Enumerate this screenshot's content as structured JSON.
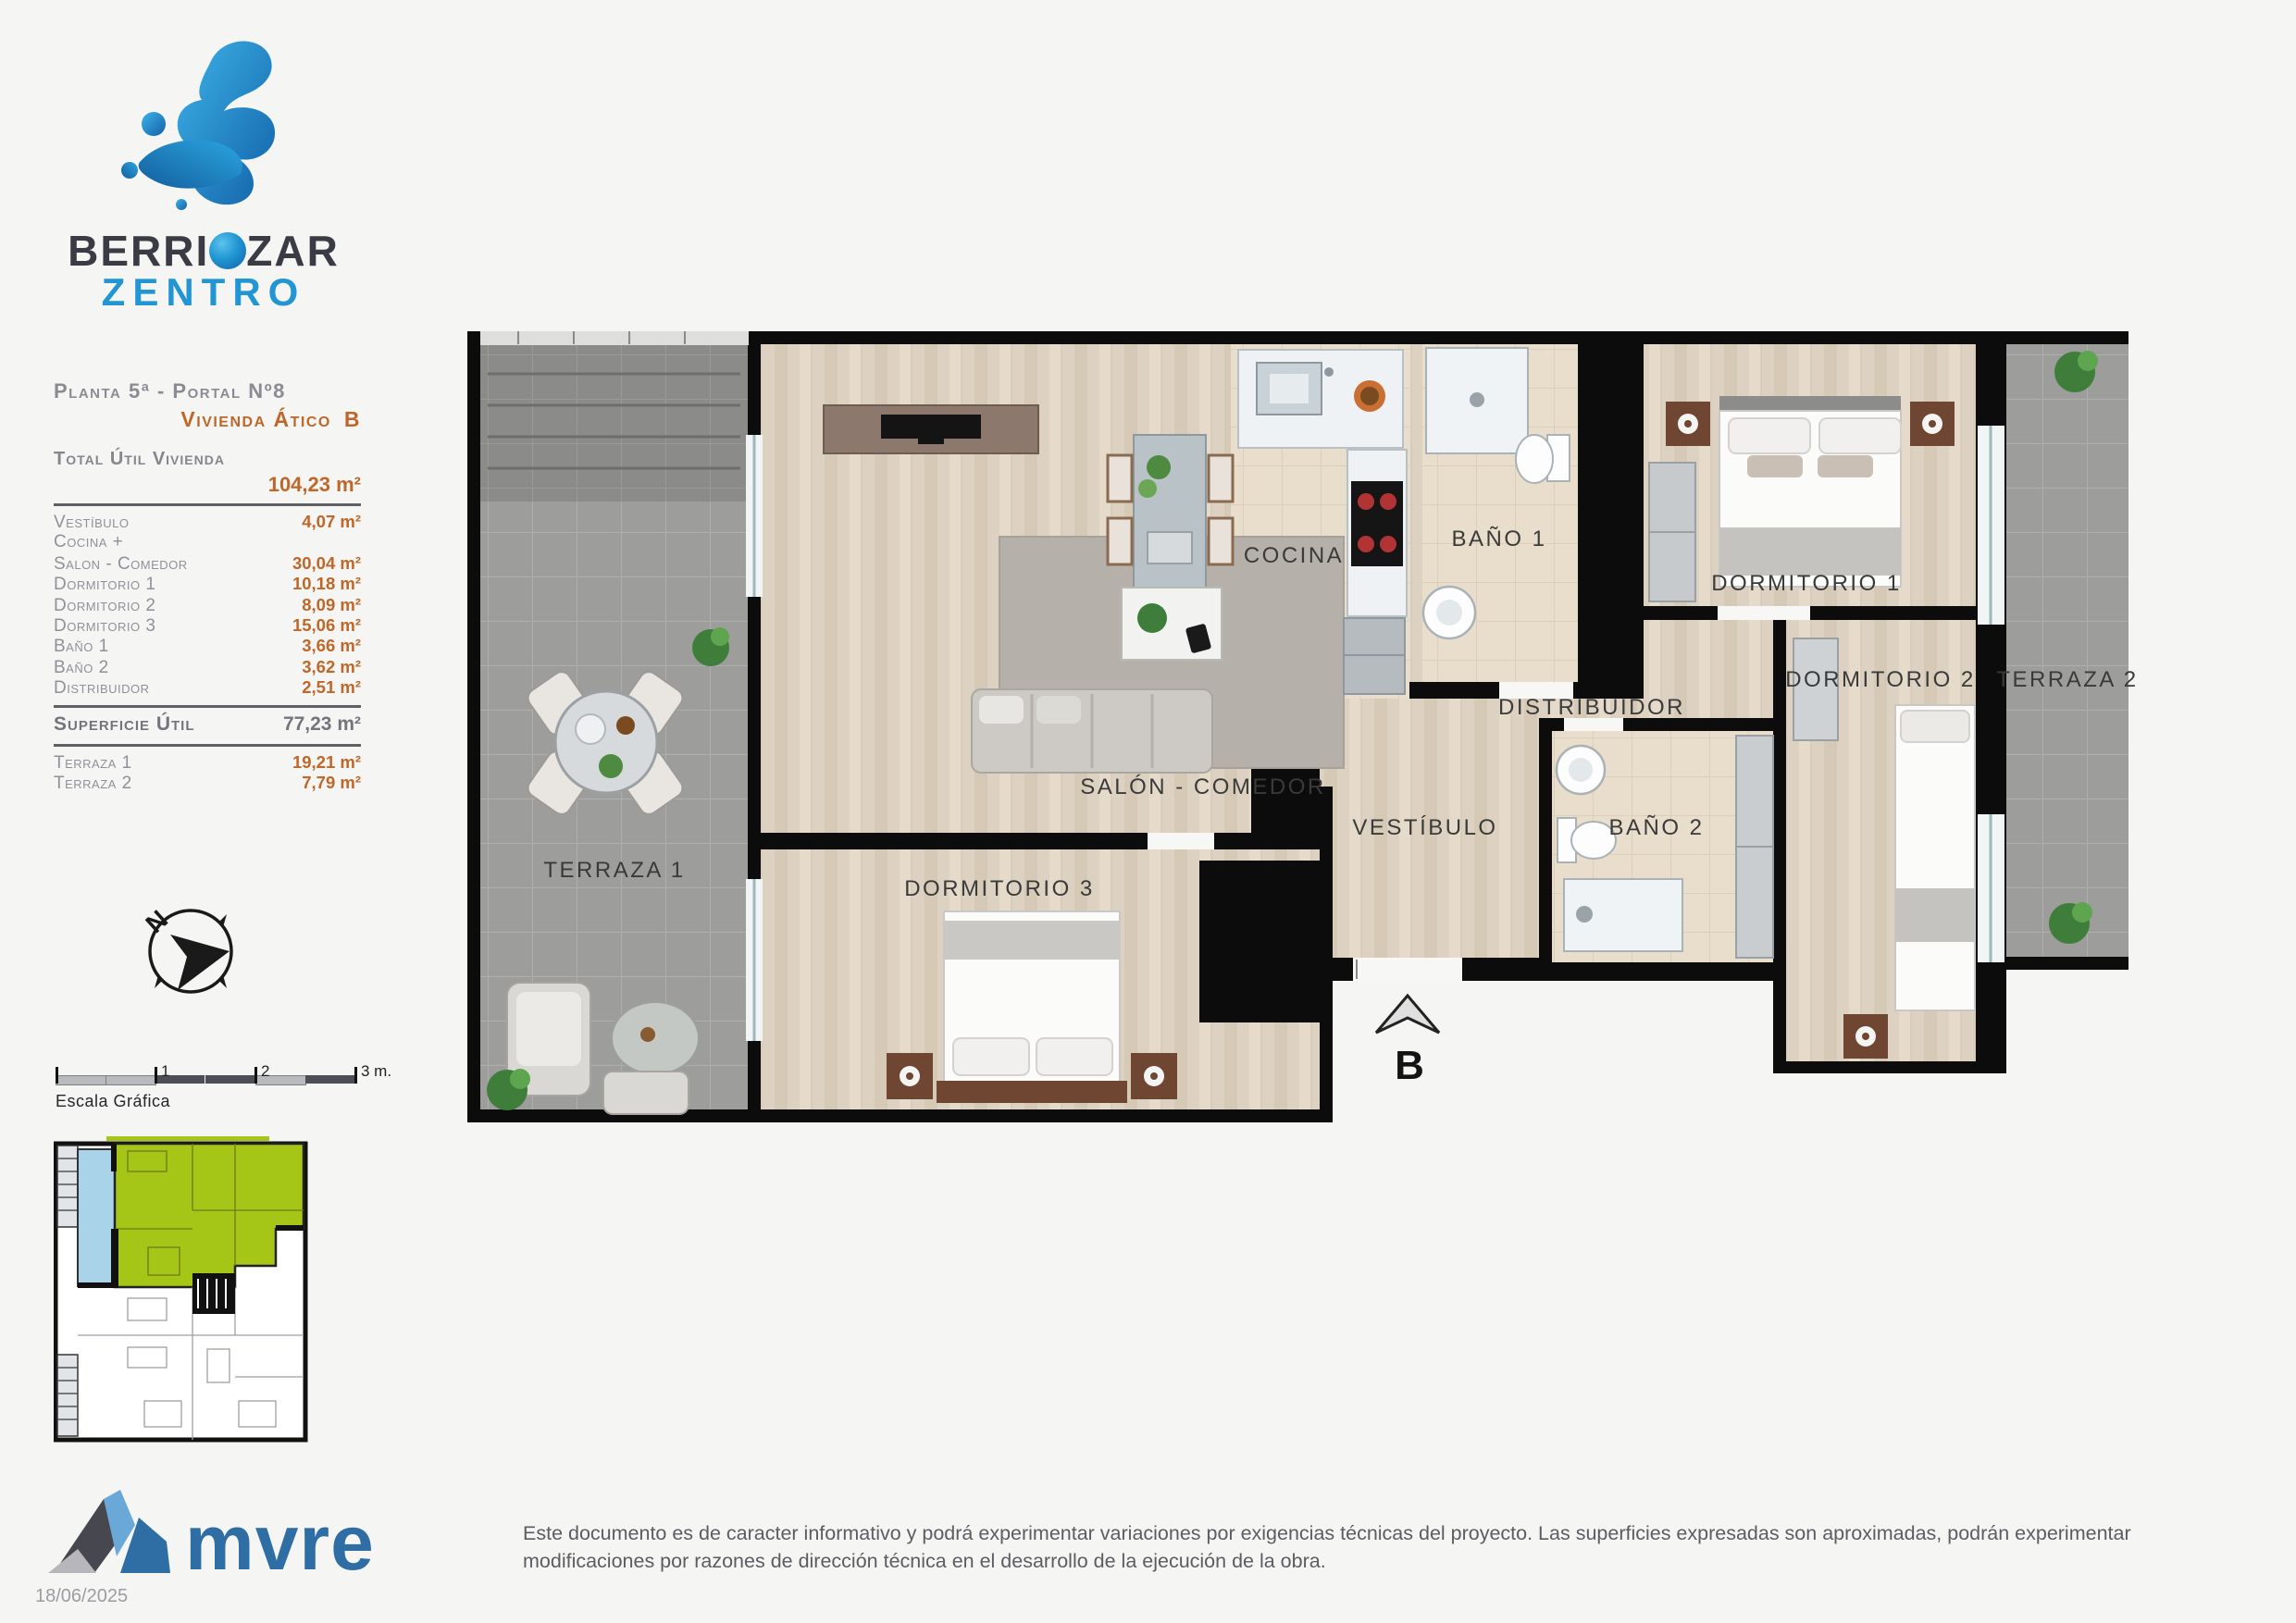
{
  "brand": {
    "name_part1": "BERRI",
    "name_part2": "ZAR",
    "name_line2": "ZENTRO"
  },
  "header": {
    "floor_line": "Planta 5ª - Portal Nº8",
    "unit_line": "Vivienda Ático",
    "unit_letter": "B"
  },
  "surface_table": {
    "total_label": "Total Útil Vivienda",
    "total_value": "104,23 m²",
    "rows": [
      {
        "label": "Vestíbulo",
        "value": "4,07 m²"
      },
      {
        "label": "Cocina +",
        "value": ""
      },
      {
        "label": "Salon - Comedor",
        "value": "30,04 m²"
      },
      {
        "label": "Dormitorio 1",
        "value": "10,18 m²"
      },
      {
        "label": "Dormitorio 2",
        "value": "8,09 m²"
      },
      {
        "label": "Dormitorio 3",
        "value": "15,06 m²"
      },
      {
        "label": "Baño 1",
        "value": "3,66 m²"
      },
      {
        "label": "Baño 2",
        "value": "3,62 m²"
      },
      {
        "label": "Distribuidor",
        "value": "2,51 m²"
      }
    ],
    "subtotal_label": "Superficie Útil",
    "subtotal_value": "77,23 m²",
    "terraces": [
      {
        "label": "Terraza 1",
        "value": "19,21 m²"
      },
      {
        "label": "Terraza 2",
        "value": "7,79 m²"
      }
    ]
  },
  "compass": {
    "north_label": "N"
  },
  "scalebar": {
    "ticks": [
      "1",
      "2",
      "3 m."
    ],
    "caption": "Escala Gráfica"
  },
  "floorplan": {
    "labels": {
      "terraza1": "TERRAZA 1",
      "salon": "SALÓN - COMEDOR",
      "cocina": "COCINA",
      "bano1": "BAÑO 1",
      "dormitorio1": "DORMITORIO 1",
      "distribuidor": "DISTRIBUIDOR",
      "dormitorio2": "DORMITORIO 2",
      "terraza2": "TERRAZA 2",
      "vestibulo": "VESTÍBULO",
      "bano2": "BAÑO 2",
      "dormitorio3": "DORMITORIO 3",
      "entrance_marker": "B"
    }
  },
  "footer": {
    "logo_text": "mvre",
    "date": "18/06/2025",
    "disclaimer": "Este documento es de caracter informativo y podrá experimentar variaciones por exigencias técnicas del proyecto. Las superficies expresadas son aproximadas, podrán experimentar modificaciones por razones de dirección técnica en el desarrollo de la ejecución de la obra."
  },
  "colors": {
    "accent_orange": "#bf6728",
    "text_gray": "#90909a",
    "brand_blue": "#2196d2",
    "brand_dark": "#3b3b46",
    "mvre_blue": "#2f6da5",
    "highlight_green": "#a6c617",
    "terrace_blue": "#a9d3e8",
    "wall_black": "#0c0c0c"
  }
}
